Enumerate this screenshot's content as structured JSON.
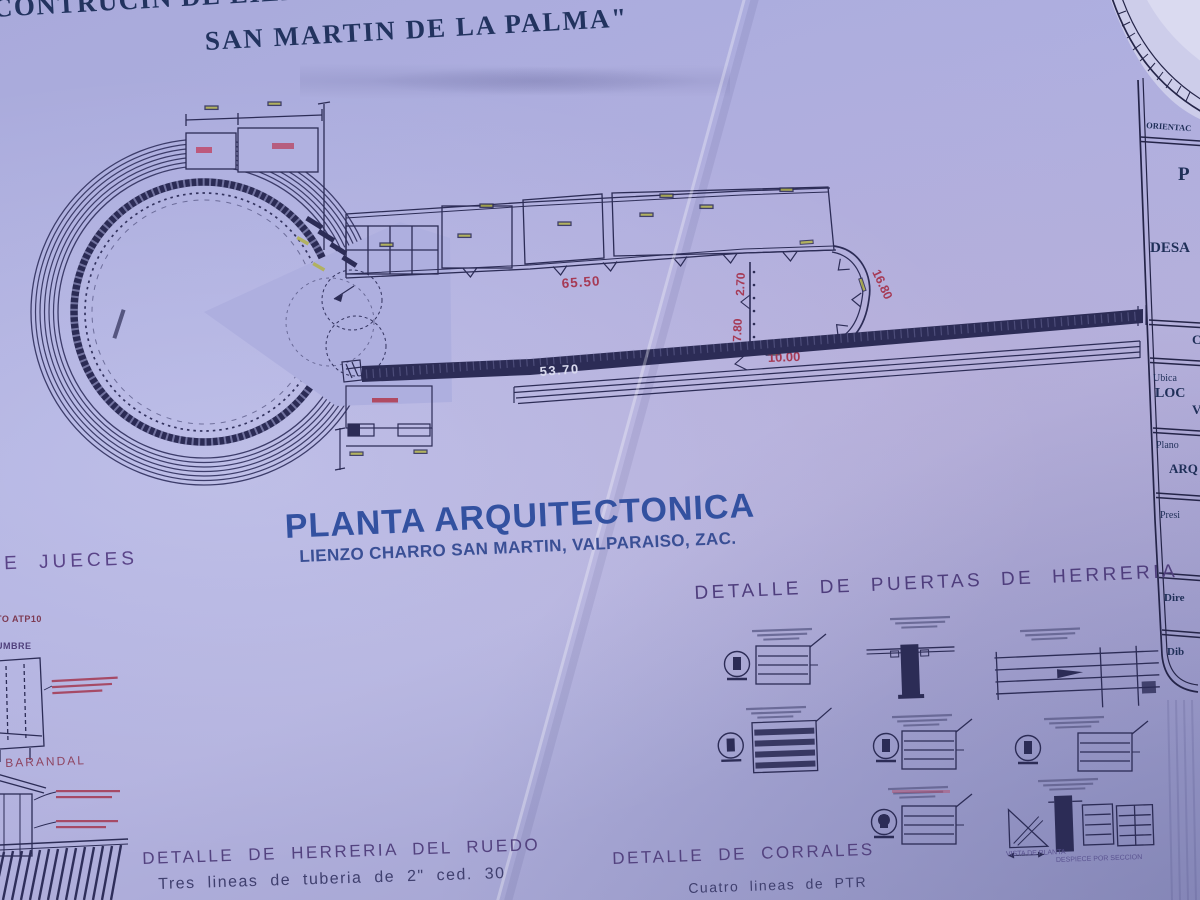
{
  "header": {
    "title_line1": "CONTRUCIN DE LIENZO EN VALPA",
    "title_line2": "SAN MARTIN DE LA PALMA\""
  },
  "plan": {
    "title": "PLANTA ARQUITECTONICA",
    "subtitle": "LIENZO CHARRO SAN MARTIN, VALPARAISO, ZAC.",
    "dims": {
      "corral_run": "65.50",
      "lienzo_len": "53.70",
      "partidero_w": "10.00",
      "partidero_curve": "16.80",
      "gate_top": "2.70",
      "gate_bottom": "7.80"
    }
  },
  "details": {
    "puertas_heading": "DETALLE DE PUERTAS DE HERRERIA",
    "ruedo_heading": "DETALLE DE HERRERIA DEL RUEDO",
    "ruedo_note": "Tres lineas de tuberia  de 2\" ced. 30",
    "corrales_heading": "DETALLE DE CORRALES",
    "corrales_note": "Cuatro lineas de PTR",
    "jueces_heading": "DE JUECES",
    "jueces_note1": "TO ATP10",
    "jueces_note2": "UMBRE",
    "barandal_label": "BARANDAL",
    "vista_label": "VISTA DE PLANTA",
    "despiece_label": "DESPIECE POR SECCION"
  },
  "titleblock": {
    "orientacion": "ORIENTAC",
    "p_letter": "P",
    "desa": "DESA",
    "c_letter": "C",
    "ubica": "Ubica",
    "loc": "LOC",
    "v_letter": "V",
    "plano": "Plano",
    "arq": "ARQ",
    "presi": "Presi",
    "dire": "Dire",
    "dib": "Dib"
  },
  "colors": {
    "paper": "#acaddd",
    "ink": "#2c2c56",
    "title_navy": "#22335f",
    "plan_blue": "#3351a0",
    "heading_purple": "#4f3e7d",
    "dim_red": "#a63a55",
    "dim_yellow": "#b2b24a"
  }
}
